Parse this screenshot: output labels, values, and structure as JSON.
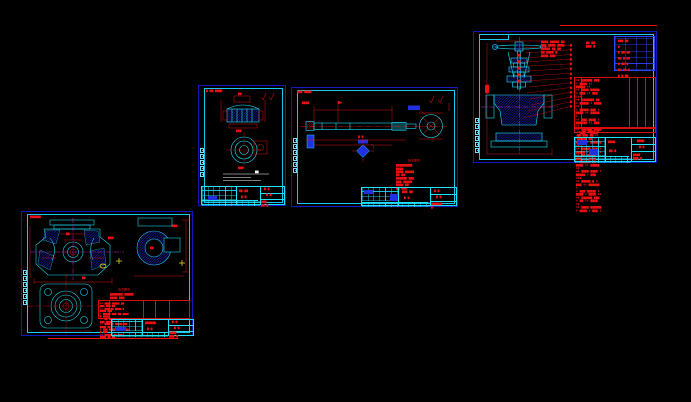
{
  "app": {
    "background": "#000000"
  },
  "colors": {
    "sheet_border_blue": "#1018c0",
    "frame_cyan": "#18c8ee",
    "geometry_cyan": "#1ee3ff",
    "hatch_blue": "#2230ff",
    "dimension_red": "#f21010",
    "centerline_magenta": "#ff2bff",
    "highlight_yellow": "#ffe81e",
    "note_white": "#ffffff"
  },
  "sheets": {
    "assembly": {
      "notes_lines": [
        "▆▆▆▆ ▆▆▆▆▆ ▆▆",
        "▆▆▆ ▆▆▆▆ ▆▆▆▆",
        "▆▆▆▆▆ ▆▆ ▆▆",
        "▆▆ ▆▆▆▆ ▆",
        "▆▆▆▆ ▆▆▆"
      ],
      "notes_side": [
        "▆▆ ▆▆",
        "▆▆▆ ▆"
      ],
      "param_table_rows": [
        "▆▆▆ ▆▆ ▆",
        "▆ ▆▆ ▆▆",
        "▆▆ ▆ ▆▆",
        "▆ ▆▆ ▆",
        "▆▆ ▆▆ ▆",
        "▆ ▆ ▆▆"
      ],
      "balloon_numbers": [
        "▆",
        "▆",
        "▆",
        "▆",
        "▆",
        "▆",
        "▆",
        "▆",
        "▆",
        "▆",
        "▆",
        "▆",
        "▆",
        "▆"
      ],
      "bom_rows": [
        "▮▮ ▆▆▆▆▆▆ ▆▆▆ ▮ ▆▆▆▆ ▮▮ ▆▆▆▆▆ ▮▮",
        "▮▮ ▆▆▆▆ ▆▆▆▆▆ ▮ ▆▆▆ ▮▮ ▆▆▆ ▮▮▮",
        "▮▮ ▆▆▆▆▆▆▆ ▆▆ ▮ ▆▆▆▆▆ ▮ ▆▆▆▆ ▮▮",
        "▮ ▆▆▆▆▆ ▆▆▆ ▮ ▆▆▆▆ ▮▮ ▆▆▆▆▆ ▮",
        "▮▮ ▆▆▆ ▆▆▆▆ ▮ ▆▆▆▆▆▆ ▮▮ ▆▆▆ ▮▮",
        "▮▮ ▆▆▆▆▆▆ ▆▆▆▆ ▮ ▆▆▆ ▮ ▆▆▆▆ ▮▮▮",
        "▮ ▆▆▆▆ ▆▆ ▮ ▆▆▆▆ ▮▮ ▆▆▆▆▆▆ ▮▮",
        "▮▮ ▆▆▆▆▆ ▆▆▆ ▮ ▆▆▆▆▆ ▮ ▆▆▆ ▮▮",
        "▮▮ ▆▆ ▆▆▆▆▆ ▮ ▆▆▆ ▮▮ ▆▆▆▆ ▮",
        "▮ ▆▆▆▆▆▆ ▆▆ ▮ ▆▆▆▆ ▮▮ ▆▆▆▆▆ ▮▮",
        "▮▮ ▆▆▆▆ ▆▆▆▆ ▮ ▆▆▆▆▆ ▮ ▆▆▆ ▮▮▮",
        "▮▮ ▆▆▆▆▆ ▆ ▮ ▆▆▆ ▮▮ ▆▆▆▆▆▆ ▮",
        "▮ ▆▆▆ ▆▆▆▆▆ ▮ ▆▆▆▆ ▮ ▆▆▆▆ ▮▮",
        "▮▮ ▆▆▆▆▆▆ ▆▆▆ ▮ ▆▆ ▮▮ ▆▆▆▆ ▮▮",
        "▮▮ ▆▆▆▆ ▆▆▆▆▆▆ ▮ ▆▆▆▆ ▮ ▆▆▆ ▮"
      ],
      "bom_header": "▮▮ ▆▆ ▆▆▆▆ ▆ ▆▆ ▆▆▆ ▆▆ ▮▮ ▆▆",
      "title_block": {
        "product": "▆▆▆▆",
        "material": "▆▆ ▆",
        "scale": "▆:▆",
        "drawing_no": "▆▆▆▆-▆▆▆-▆"
      }
    },
    "gland": {
      "corner_tag": "▆-▆▆-▆▆▆▆",
      "top_view_dim": "▆▆",
      "top_view_label": "▆▆▆",
      "circle_view_label": "▆▆▆",
      "white_note": "▆▆",
      "title_block": {
        "product": "▆▆ ▆▆",
        "material": "▆ ▆",
        "scale": "▆:▆",
        "drawing_no": "▆▆▆-▆▆-▆"
      }
    },
    "stem": {
      "corner_tag": "▆▆▆-▆▆▆▆",
      "dim_tag": "▆▆▆▆",
      "section_tag": "▆-▆",
      "notes_title": "技术要求",
      "notes_lines": [
        "▆▆▆▆▆▆▆▆▆ ▆▆▆▆",
        "▆▆▆▆ ▆▆▆▆▆ ▆▆ ▆▆",
        "▆▆▆▆▆▆ ▆▆▆",
        "▆▆▆ ▆▆▆▆▆",
        "▆▆▆▆ ▆▆",
        "▆▆ ▆▆▆"
      ],
      "title_block": {
        "product": "▆▆▆ ▆▆",
        "material": "▆ ▆",
        "scale": "▆:▆",
        "drawing_no": "▆▆▆▆▆▆-▆"
      }
    },
    "body": {
      "corner_tag": "▆▆▆▆▆▆",
      "dim_tags": [
        "▆▆",
        "▆▆▆",
        "▆▆",
        "▆▆▆",
        "▆▆"
      ],
      "notes_title": "技术要求",
      "notes_lines": [
        "▆▆▆▆▆▆▆ ▆▆▆▆▆",
        "▆▆▆▆ ▆▆▆"
      ],
      "table_rows": [
        "▮▮ ▆▆▆▆ ▆▆▆▆▆ ▆▆ ▆▆▆ ▆▆▆ ▆▆",
        "▮▮ ▆▆▆ ▆▆ ▆▆▆▆ ▆ ▆▆▆▆ ▆▆▆",
        "▮ ▆▆▆▆▆ ▆▆▆ ▆▆ ▆▆▆▆ ▆ ▆▆▆▆",
        "▮▮ ▆▆ ▆▆▆▆▆ ▆▆▆ ▆ ▆▆▆ ▆▆▆▆",
        "▮▮ ▆▆▆▆ ▆ ▆▆▆▆▆ ▆▆ ▆▆▆▆ ▆▆",
        "▮ ▆▆▆ ▆▆▆▆ ▆▆ ▆▆▆▆▆ ▆ ▆▆▆",
        "▮▮ ▆▆▆▆▆ ▆▆ ▆▆▆ ▆▆▆▆ ▆▆ ▆▆"
      ],
      "title_block": {
        "product": "▆▆▆▆▆▆",
        "material": "▆ ▆",
        "scale": "▆:▆",
        "drawing_no": "▆▆▆▆-▆▆▆-▆"
      }
    }
  }
}
